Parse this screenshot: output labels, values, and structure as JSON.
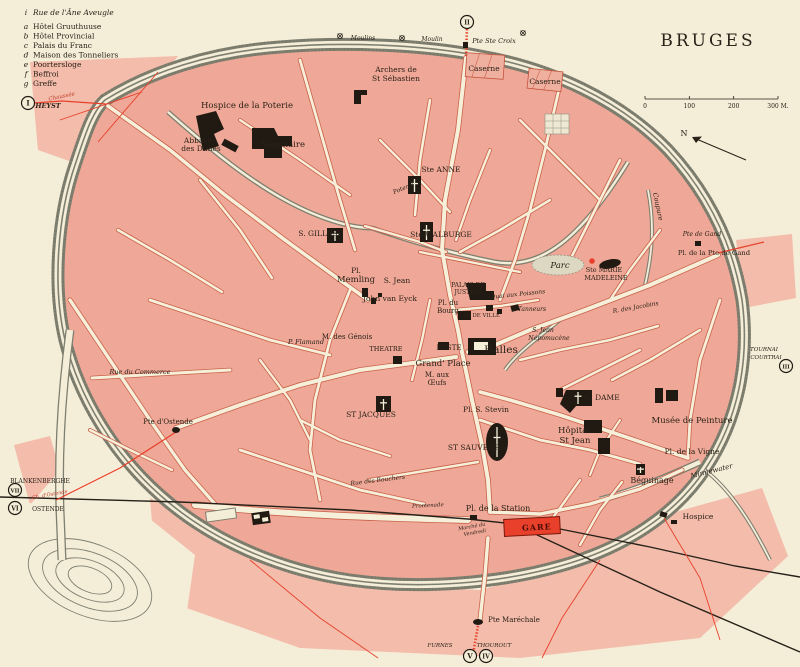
{
  "title": "BRUGES",
  "legend": {
    "items": [
      {
        "key": "i",
        "label": "Rue de l'Âne Aveugle"
      },
      {
        "key": "a",
        "label": "Hôtel Gruuthuuse"
      },
      {
        "key": "b",
        "label": "Hôtel Provincial"
      },
      {
        "key": "c",
        "label": "Palais du Franc"
      },
      {
        "key": "d",
        "label": "Maison des Tonneliers"
      },
      {
        "key": "e",
        "label": "Poortersloge"
      },
      {
        "key": "f",
        "label": "Beffroi"
      },
      {
        "key": "g",
        "label": "Greffe"
      }
    ]
  },
  "scale": {
    "tick_labels": [
      "0",
      "100",
      "200",
      "300 M."
    ]
  },
  "compass": {
    "label": "N"
  },
  "station": {
    "gare_label": "GARE"
  },
  "gates": [
    {
      "numeral": "I",
      "x": 28,
      "y": 103
    },
    {
      "numeral": "II",
      "x": 467,
      "y": 22
    },
    {
      "numeral": "III",
      "x": 786,
      "y": 366
    },
    {
      "numeral": "IV",
      "x": 486,
      "y": 656
    },
    {
      "numeral": "V",
      "x": 470,
      "y": 656
    },
    {
      "numeral": "VI",
      "x": 15,
      "y": 508
    },
    {
      "numeral": "VII",
      "x": 15,
      "y": 490
    }
  ],
  "map_labels": [
    {
      "t": "Hospice de la Poterie",
      "x": 247,
      "y": 108,
      "s": 8.5
    },
    {
      "t": "Abbaye",
      "x": 198,
      "y": 143,
      "s": 7.5
    },
    {
      "t": "des Dunes",
      "x": 201,
      "y": 151,
      "s": 7.5
    },
    {
      "t": "Séminaire",
      "x": 283,
      "y": 147,
      "s": 8.5
    },
    {
      "t": "Archers de",
      "x": 396,
      "y": 72,
      "s": 7.5
    },
    {
      "t": "St Sébastien",
      "x": 396,
      "y": 81,
      "s": 7.5
    },
    {
      "t": "Caserne",
      "x": 484,
      "y": 71,
      "s": 7.5
    },
    {
      "t": "Caserne",
      "x": 545,
      "y": 84,
      "s": 7.5
    },
    {
      "t": "Pte Ste Croix",
      "x": 494,
      "y": 43,
      "s": 6.5,
      "i": 1
    },
    {
      "t": "Moulins",
      "x": 363,
      "y": 40,
      "s": 6,
      "i": 1
    },
    {
      "t": "Moulin",
      "x": 432,
      "y": 41,
      "s": 6,
      "i": 1
    },
    {
      "t": "Ste ANNE",
      "x": 441,
      "y": 172,
      "s": 7.5
    },
    {
      "t": "Ste WALBURGE",
      "x": 441,
      "y": 237,
      "s": 7.5
    },
    {
      "t": "S. GILLES",
      "x": 318,
      "y": 236,
      "s": 7.5
    },
    {
      "t": "Pl.",
      "x": 356,
      "y": 273,
      "s": 7.5
    },
    {
      "t": "Memling",
      "x": 356,
      "y": 282,
      "s": 8.5
    },
    {
      "t": "S. Jean",
      "x": 397,
      "y": 283,
      "s": 7.5
    },
    {
      "t": "John van Eyck",
      "x": 390,
      "y": 301,
      "s": 7.5
    },
    {
      "t": "Ste MARIE",
      "x": 604,
      "y": 272,
      "s": 6.5
    },
    {
      "t": "MADELEINE",
      "x": 606,
      "y": 280,
      "s": 6.5
    },
    {
      "t": "Parc",
      "x": 560,
      "y": 268,
      "s": 8.5,
      "i": 1
    },
    {
      "t": "Coupure",
      "x": 656,
      "y": 207,
      "s": 6.5,
      "i": 1,
      "r": 78
    },
    {
      "t": "Pte de Gand",
      "x": 702,
      "y": 236,
      "s": 6.2,
      "i": 1
    },
    {
      "t": "Pl. de la Pte de Gand",
      "x": 714,
      "y": 255,
      "s": 6.8
    },
    {
      "t": "PALAIS DE",
      "x": 468,
      "y": 287,
      "s": 6
    },
    {
      "t": "JUSTICE",
      "x": 468,
      "y": 294,
      "s": 6
    },
    {
      "t": "Pl. du",
      "x": 448,
      "y": 305,
      "s": 7
    },
    {
      "t": "Bourg",
      "x": 448,
      "y": 313,
      "s": 7
    },
    {
      "t": "H. DE VILLE",
      "x": 482,
      "y": 317,
      "s": 5.5
    },
    {
      "t": "Quai aux Poissons",
      "x": 518,
      "y": 296,
      "s": 6,
      "i": 1,
      "r": -6
    },
    {
      "t": "Tanneurs",
      "x": 532,
      "y": 311,
      "s": 6,
      "i": 1
    },
    {
      "t": "S. Jean",
      "x": 543,
      "y": 332,
      "s": 6.2,
      "i": 1
    },
    {
      "t": "Népomucène",
      "x": 549,
      "y": 340,
      "s": 6.2,
      "i": 1
    },
    {
      "t": "POSTE",
      "x": 449,
      "y": 350,
      "s": 7
    },
    {
      "t": "Halles",
      "x": 501,
      "y": 353,
      "s": 10.5
    },
    {
      "t": "Grand' Place",
      "x": 443,
      "y": 366,
      "s": 8.5
    },
    {
      "t": "M. aux",
      "x": 437,
      "y": 377,
      "s": 7
    },
    {
      "t": "Œufs",
      "x": 437,
      "y": 385,
      "s": 7
    },
    {
      "t": "THEATRE",
      "x": 386,
      "y": 351,
      "s": 6.5
    },
    {
      "t": "M. des Génois",
      "x": 347,
      "y": 339,
      "s": 7
    },
    {
      "t": "P. Flamand",
      "x": 306,
      "y": 344,
      "s": 6.5,
      "i": 1
    },
    {
      "t": "ST JACQUES",
      "x": 371,
      "y": 417,
      "s": 7.5
    },
    {
      "t": "Rue du Commerce",
      "x": 140,
      "y": 374,
      "s": 6.5,
      "i": 1
    },
    {
      "t": "Pte d'Ostende",
      "x": 168,
      "y": 424,
      "s": 7
    },
    {
      "t": "Pl. S. Stevin",
      "x": 486,
      "y": 412,
      "s": 7.5
    },
    {
      "t": "ST SAUVEUR",
      "x": 474,
      "y": 450,
      "s": 7.5
    },
    {
      "t": "N. DAME",
      "x": 602,
      "y": 400,
      "s": 7.5
    },
    {
      "t": "Hôpital",
      "x": 574,
      "y": 433,
      "s": 8.5
    },
    {
      "t": "St Jean",
      "x": 575,
      "y": 443,
      "s": 8.5
    },
    {
      "t": "Musée de Peinture",
      "x": 692,
      "y": 423,
      "s": 8.5
    },
    {
      "t": "Pl. de la Vigne",
      "x": 692,
      "y": 454,
      "s": 7.5
    },
    {
      "t": "Minnewater",
      "x": 712,
      "y": 473,
      "s": 7,
      "i": 1,
      "r": -14
    },
    {
      "t": "Béguinage",
      "x": 652,
      "y": 483,
      "s": 8
    },
    {
      "t": "Hospice",
      "x": 698,
      "y": 519,
      "s": 7.5
    },
    {
      "t": "Pl. de la Station",
      "x": 498,
      "y": 511,
      "s": 8
    },
    {
      "t": "Marché du",
      "x": 472,
      "y": 528,
      "s": 5,
      "i": 1,
      "r": -10
    },
    {
      "t": "Vendredi",
      "x": 475,
      "y": 534,
      "s": 5,
      "i": 1,
      "r": -10
    },
    {
      "t": "Promenade",
      "x": 428,
      "y": 507,
      "s": 5.5,
      "i": 1,
      "r": -3
    },
    {
      "t": "Poterie",
      "x": 404,
      "y": 190,
      "s": 6,
      "i": 1,
      "r": -22
    },
    {
      "t": "Rue des Bouchers",
      "x": 378,
      "y": 482,
      "s": 6,
      "i": 1,
      "r": -7
    },
    {
      "t": "R. des Jacobins",
      "x": 636,
      "y": 309,
      "s": 6,
      "i": 1,
      "r": -10
    },
    {
      "t": "Pte Maréchale",
      "x": 514,
      "y": 622,
      "s": 7
    },
    {
      "t": "HEYST",
      "x": 48,
      "y": 108,
      "s": 6.5,
      "i": 1,
      "b": 1
    },
    {
      "t": "Chaussée",
      "x": 62,
      "y": 98,
      "s": 5.5,
      "i": 1,
      "r": -12,
      "c": "red"
    },
    {
      "t": "BLANKENBERGHE",
      "x": 40,
      "y": 483,
      "s": 6
    },
    {
      "t": "OSTENDE",
      "x": 48,
      "y": 511,
      "s": 6
    },
    {
      "t": "Ch. d'Ostende",
      "x": 50,
      "y": 496,
      "s": 5,
      "i": 1,
      "r": -10,
      "c": "red"
    },
    {
      "t": "FURNES",
      "x": 440,
      "y": 647,
      "s": 5.5,
      "i": 1
    },
    {
      "t": "THOUROUT",
      "x": 494,
      "y": 647,
      "s": 5.5,
      "i": 1
    },
    {
      "t": "TOURNAI",
      "x": 764,
      "y": 351,
      "s": 5.5,
      "i": 1
    },
    {
      "t": "COURTRAI",
      "x": 766,
      "y": 359,
      "s": 5.5,
      "i": 1
    }
  ],
  "colors": {
    "paper": "#f4eed9",
    "block_pink": "#efa897",
    "suburb_pink": "#f3bcab",
    "street_cream": "#f6efd9",
    "street_casing": "#c9614a",
    "canal_gray": "#7f7f70",
    "building_black": "#211a13",
    "accent_red": "#e8402a",
    "ink": "#2b2118"
  }
}
